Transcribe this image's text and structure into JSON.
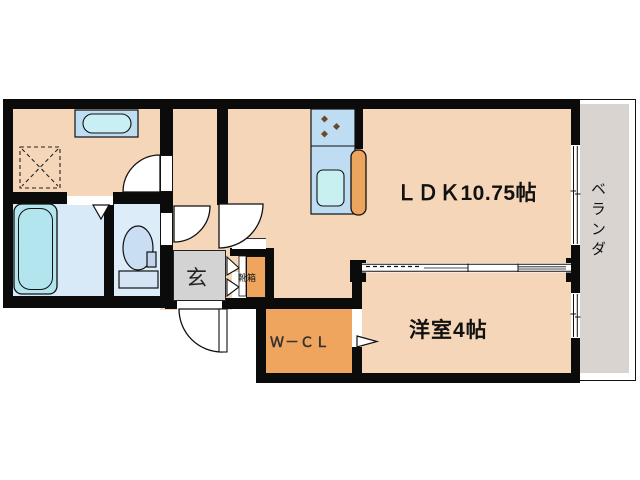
{
  "floorplan": {
    "rooms": {
      "ldk": {
        "label": "ＬＤＫ10.75帖"
      },
      "bedroom": {
        "label": "洋室4帖"
      },
      "closet": {
        "label": "Ｗ－ＣＬ"
      },
      "entrance": {
        "label": "玄"
      },
      "shoe_box": {
        "label": "靴箱"
      },
      "veranda": {
        "label": "ベランダ"
      }
    },
    "fixtures": [
      "bathtub",
      "toilet",
      "wash-basin",
      "washing-machine-space",
      "kitchen-stove",
      "kitchen-sink",
      "kitchen-counter",
      "entrance-door",
      "room-doors",
      "sliding-doors",
      "windows",
      "shoe-cabinet"
    ],
    "colors": {
      "room_beige": "#f6d6b8",
      "accent_orange": "#efa55e",
      "counter_orange": "#eda45c",
      "water_blue": "#bedcf2",
      "tub_cyan": "#b2e5ee",
      "bath_floor": "#d8e9f7",
      "genkan_gray": "#d3d3d3",
      "veranda_gray": "#d9d4cf",
      "wall_black": "#0b0b0b"
    }
  }
}
